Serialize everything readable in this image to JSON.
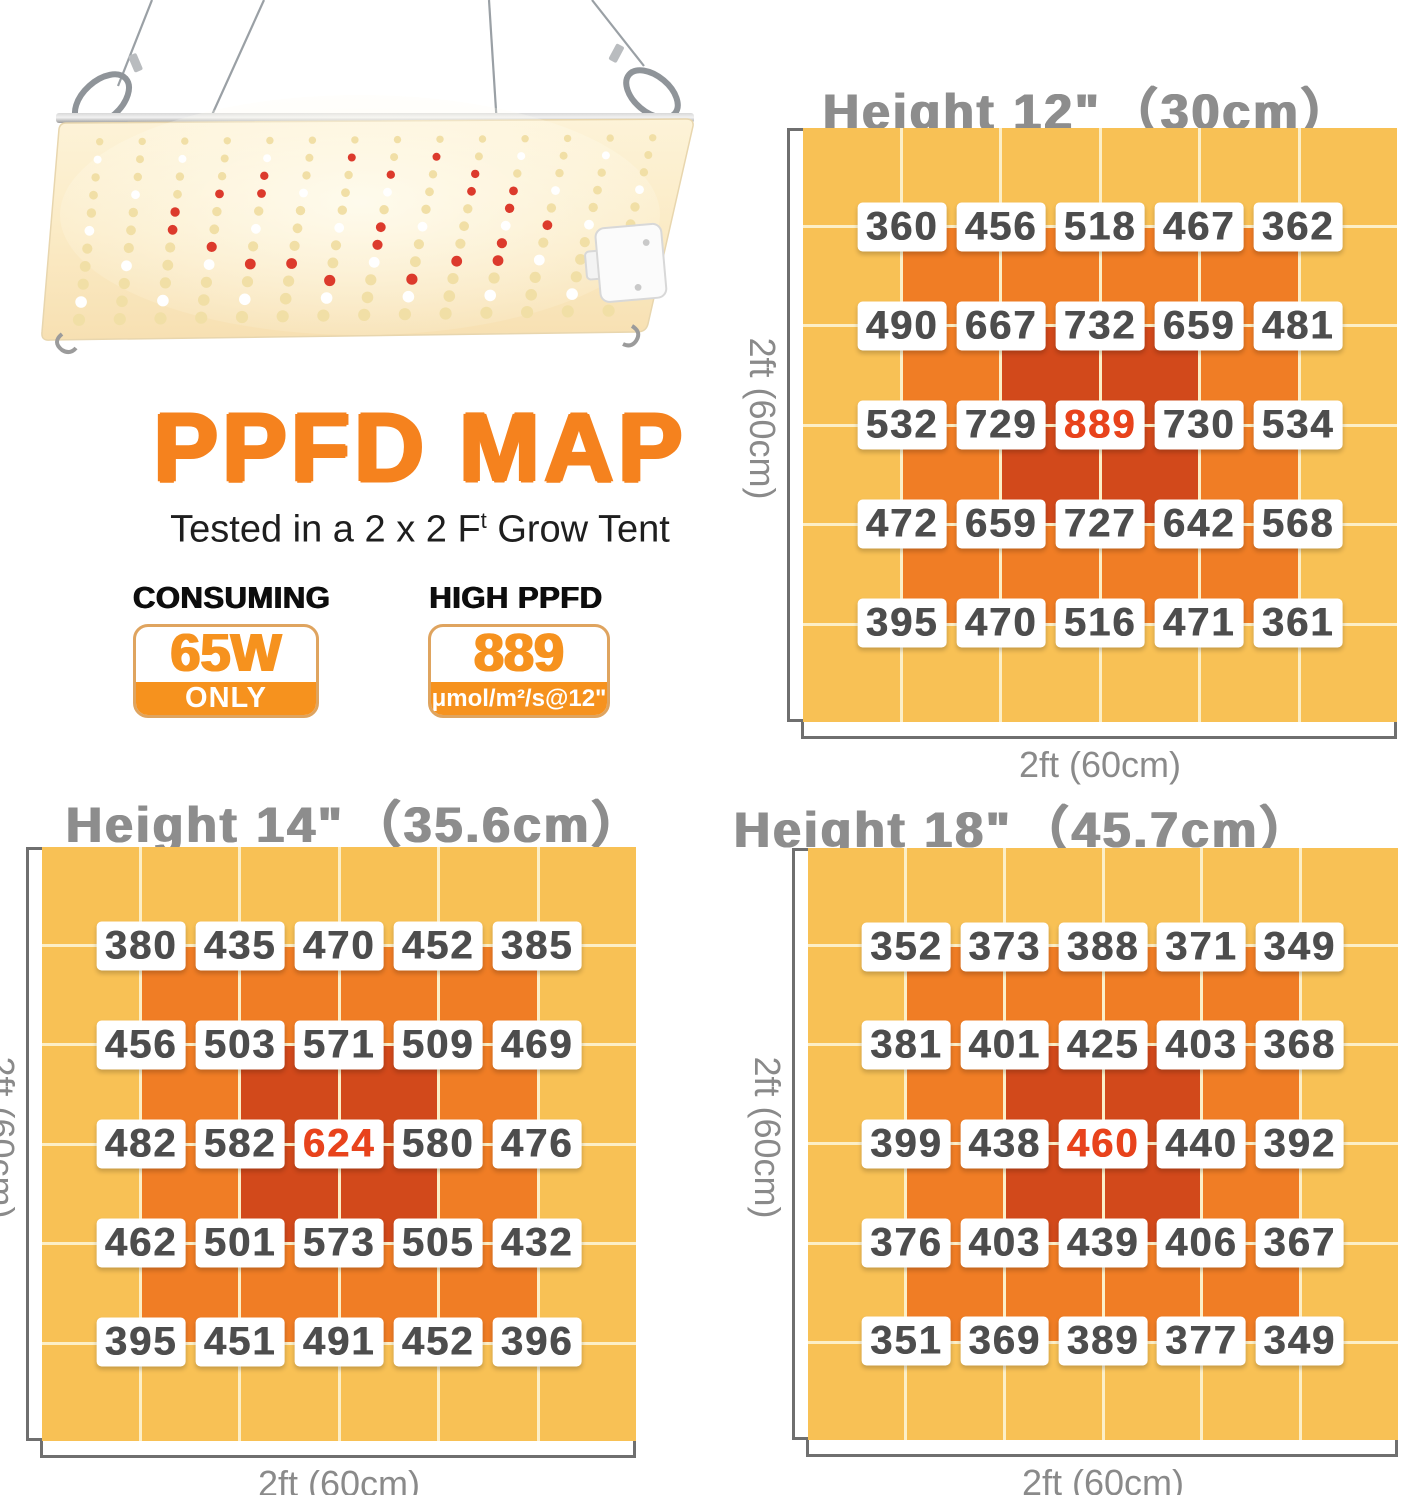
{
  "header": {
    "title": "PPFD MAP",
    "subtitle_prefix": "Tested in a 2 x 2 F",
    "subtitle_sup": "t",
    "subtitle_suffix": " Grow Tent"
  },
  "badges": {
    "consuming": {
      "heading": "CONSUMING",
      "value": "65W",
      "strip": "ONLY"
    },
    "high_ppfd": {
      "heading": "HIGH PPFD",
      "value": "889",
      "strip": "μmol/m²/s@12\""
    }
  },
  "colors": {
    "accent_orange": "#F5821E",
    "badge_orange": "#F6921E",
    "badge_border": "#DFA45F",
    "title_gray": "#8D8D8D",
    "axis_gray": "#6F6F6F",
    "label_gray": "#8A8A8A",
    "chip_text": "#4D4D4D",
    "peak_red": "#E8431C"
  },
  "chart_data": [
    {
      "type": "heatmap",
      "id": "h12",
      "title": "Height 12\"",
      "title_paren": "（30cm）",
      "xlabel": "2ft (60cm)",
      "ylabel": "2ft (60cm)",
      "grid_cells": 6,
      "palette": {
        "outer": "#F8C155",
        "middle": "#F07D25",
        "center": "#D2491B"
      },
      "values": [
        [
          360,
          456,
          518,
          467,
          362
        ],
        [
          490,
          667,
          732,
          659,
          481
        ],
        [
          532,
          729,
          889,
          730,
          534
        ],
        [
          472,
          659,
          727,
          642,
          568
        ],
        [
          395,
          470,
          516,
          471,
          361
        ]
      ],
      "peak": {
        "row": 2,
        "col": 2,
        "value": 889
      }
    },
    {
      "type": "heatmap",
      "id": "h14",
      "title": "Height 14\"",
      "title_paren": "（35.6cm）",
      "xlabel": "2ft (60cm)",
      "ylabel": "2ft (60cm)",
      "grid_cells": 6,
      "palette": {
        "outer": "#F8C155",
        "middle": "#F07D25",
        "center": "#D2491B"
      },
      "values": [
        [
          380,
          435,
          470,
          452,
          385
        ],
        [
          456,
          503,
          571,
          509,
          469
        ],
        [
          482,
          582,
          624,
          580,
          476
        ],
        [
          462,
          501,
          573,
          505,
          432
        ],
        [
          395,
          451,
          491,
          452,
          396
        ]
      ],
      "peak": {
        "row": 2,
        "col": 2,
        "value": 624
      }
    },
    {
      "type": "heatmap",
      "id": "h18",
      "title": "Height 18\"",
      "title_paren": "（45.7cm）",
      "xlabel": "2ft (60cm)",
      "ylabel": "2ft (60cm)",
      "grid_cells": 6,
      "palette": {
        "outer": "#F8C155",
        "middle": "#F07D25",
        "center": "#D2491B"
      },
      "values": [
        [
          352,
          373,
          388,
          371,
          349
        ],
        [
          381,
          401,
          425,
          403,
          368
        ],
        [
          399,
          438,
          460,
          440,
          392
        ],
        [
          376,
          403,
          439,
          406,
          367
        ],
        [
          351,
          369,
          389,
          377,
          349
        ]
      ],
      "peak": {
        "row": 2,
        "col": 2,
        "value": 460
      }
    }
  ],
  "hero": {
    "red_leds": [
      [
        6,
        1
      ],
      [
        8,
        1
      ],
      [
        4,
        2
      ],
      [
        7,
        2
      ],
      [
        9,
        2
      ],
      [
        3,
        3
      ],
      [
        4,
        3
      ],
      [
        9,
        3
      ],
      [
        10,
        3
      ],
      [
        2,
        4
      ],
      [
        10,
        4
      ],
      [
        2,
        5
      ],
      [
        7,
        5
      ],
      [
        11,
        5
      ],
      [
        3,
        6
      ],
      [
        7,
        6
      ],
      [
        10,
        6
      ],
      [
        4,
        7
      ],
      [
        5,
        7
      ],
      [
        9,
        7
      ],
      [
        10,
        7
      ],
      [
        6,
        8
      ],
      [
        8,
        8
      ]
    ]
  }
}
